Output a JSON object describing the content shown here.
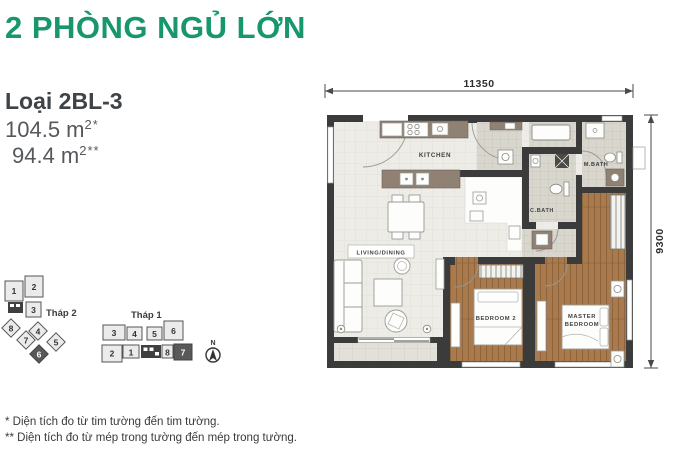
{
  "colors": {
    "accent_green": "#17976B",
    "wall": "#3B3B3B",
    "wood_floor": "#A87A4D",
    "tile_floor": "#EDECE6",
    "counter": "#8F8173",
    "highlight_unit": "#595959"
  },
  "header": {
    "title": "2 PHÒNG NGỦ LỚN",
    "unit_type": "Loại 2BL-3",
    "area_primary": "104.5 m",
    "area_primary_sup": "2*",
    "area_secondary": "94.4 m",
    "area_secondary_sup": "2**"
  },
  "floorplan": {
    "dim_top": "11350",
    "dim_right": "9300",
    "rooms": {
      "kitchen": "KITCHEN",
      "living": "LIVING/DINING",
      "bedroom2": "BEDROOM 2",
      "master_line1": "MASTER",
      "master_line2": "BEDROOM",
      "cbath": "C.BATH",
      "mbath": "M.BATH"
    }
  },
  "keyplans": {
    "tower2": {
      "label": "Tháp 2",
      "units": [
        "1",
        "2",
        "3",
        "4",
        "5",
        "6",
        "7",
        "8"
      ],
      "highlighted": "6"
    },
    "tower1": {
      "label": "Tháp 1",
      "units": [
        "1",
        "2",
        "3",
        "4",
        "5",
        "6",
        "7",
        "8"
      ],
      "highlighted": "7"
    },
    "compass_n": "N"
  },
  "footnotes": [
    "* Diện tích đo từ tim tường đến tim tường.",
    "** Diện tích đo từ mép trong tường đến mép trong tường."
  ]
}
